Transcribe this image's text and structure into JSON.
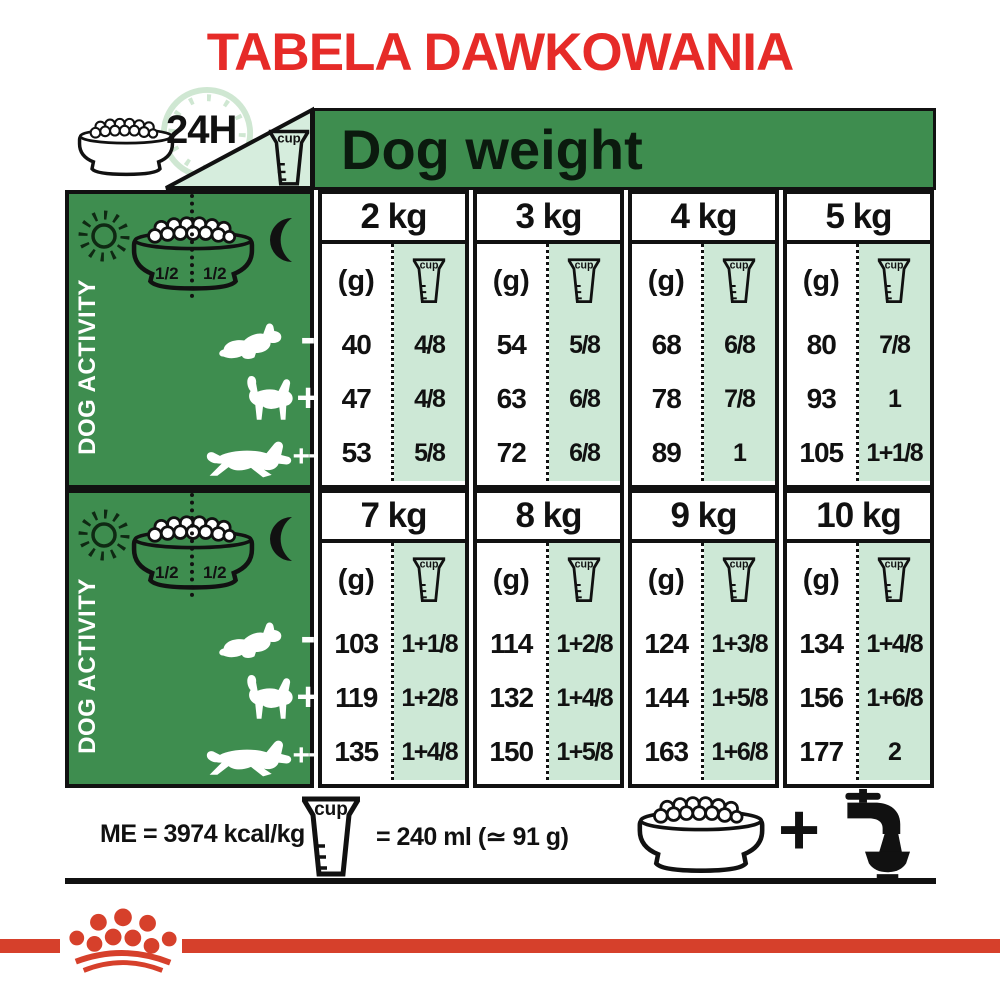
{
  "title": {
    "text": "TABELA DAWKOWANIA"
  },
  "header": {
    "hours": "24H",
    "cup_label": "cup",
    "dog_weight": "Dog weight"
  },
  "sections": [
    {
      "activity_label": "DOG ACTIVITY",
      "halves": [
        "1/2",
        "1/2"
      ],
      "levels": [
        "-",
        "+",
        "++"
      ],
      "grams_label": "(g)",
      "columns": [
        {
          "weight": "2 kg",
          "g": [
            "40",
            "47",
            "53"
          ],
          "cups": [
            "4/8",
            "4/8",
            "5/8"
          ]
        },
        {
          "weight": "3 kg",
          "g": [
            "54",
            "63",
            "72"
          ],
          "cups": [
            "5/8",
            "6/8",
            "6/8"
          ]
        },
        {
          "weight": "4 kg",
          "g": [
            "68",
            "78",
            "89"
          ],
          "cups": [
            "6/8",
            "7/8",
            "1"
          ]
        },
        {
          "weight": "5 kg",
          "g": [
            "80",
            "93",
            "105"
          ],
          "cups": [
            "7/8",
            "1",
            "1+1/8"
          ]
        }
      ]
    },
    {
      "activity_label": "DOG ACTIVITY",
      "halves": [
        "1/2",
        "1/2"
      ],
      "levels": [
        "-",
        "+",
        "++"
      ],
      "grams_label": "(g)",
      "columns": [
        {
          "weight": "7 kg",
          "g": [
            "103",
            "119",
            "135"
          ],
          "cups": [
            "1+1/8",
            "1+2/8",
            "1+4/8"
          ]
        },
        {
          "weight": "8 kg",
          "g": [
            "114",
            "132",
            "150"
          ],
          "cups": [
            "1+2/8",
            "1+4/8",
            "1+5/8"
          ]
        },
        {
          "weight": "9 kg",
          "g": [
            "124",
            "144",
            "163"
          ],
          "cups": [
            "1+3/8",
            "1+5/8",
            "1+6/8"
          ]
        },
        {
          "weight": "10 kg",
          "g": [
            "134",
            "156",
            "177"
          ],
          "cups": [
            "1+4/8",
            "1+6/8",
            "2"
          ]
        }
      ]
    }
  ],
  "legend": {
    "me": "ME = 3974 kcal/kg",
    "volume": "= 240 ml (≃ 91 g)",
    "plus": "+"
  },
  "colors": {
    "title_red": "#e62b28",
    "brand_red": "#d6402b",
    "green": "#3e8d4f",
    "light_green": "#d6eddd",
    "cell_green": "#cde8d6"
  }
}
